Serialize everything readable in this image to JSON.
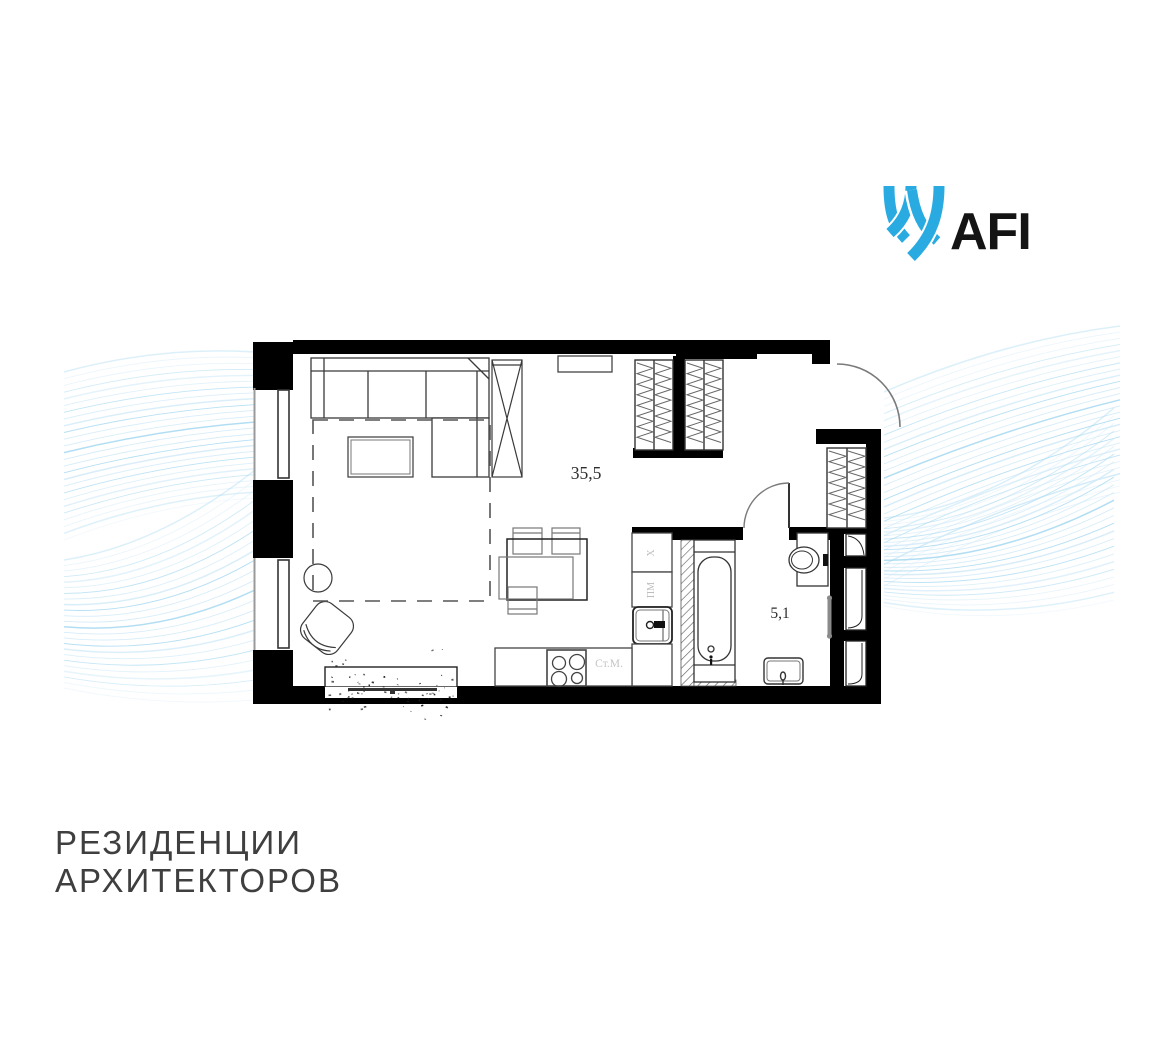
{
  "brand": {
    "name": "AFI",
    "logo_color": "#29ABE2",
    "text_color": "#141414",
    "icon": "afi-ribbons-icon"
  },
  "project": {
    "title_line1": "РЕЗИДЕНЦИИ",
    "title_line2": "АРХИТЕКТОРОВ"
  },
  "floorplan": {
    "rooms": [
      {
        "name": "living-kitchen",
        "area_label": "35,5"
      },
      {
        "name": "bathroom",
        "area_label": "5,1"
      }
    ],
    "appliance_labels": {
      "fridge": "Х",
      "dishwasher": "ПМ",
      "washing_machine": "Ст.М."
    },
    "colors": {
      "wall": "#000000",
      "furniture_line": "#3a3a3a",
      "light_line": "#777777",
      "label_dark": "#2e2e2e",
      "label_light": "#bdbdbd",
      "hatch": "#666666",
      "wave_light": "#cfe9f8",
      "wave_mid": "#a5d8f1"
    }
  }
}
